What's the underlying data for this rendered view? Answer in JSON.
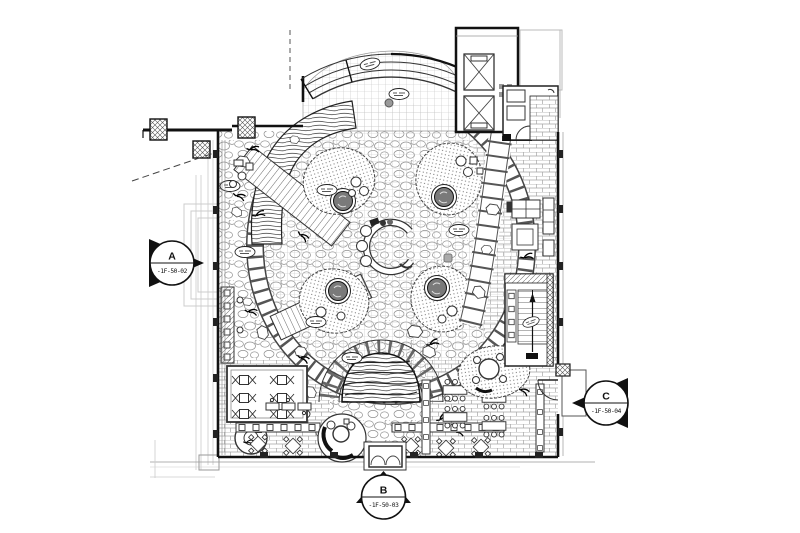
{
  "drawing": {
    "kind": "architectural-floor-plan",
    "description": "First floor restaurant / lounge plan with central C-shaped counter, oval planting islands, stone band, stair and elevator core"
  },
  "markers": {
    "a": {
      "letter": "A",
      "code": "-1F-50-02"
    },
    "b": {
      "letter": "B",
      "code": "-1F-50-03"
    },
    "c": {
      "letter": "C",
      "code": "-1F-50-04"
    }
  },
  "icons": {
    "tree-icon": "●",
    "elevator-x-icon": "✕",
    "stair-arrow-icon": "↑",
    "keynote-tag-icon": "▭",
    "section-arrow-icon": "▶"
  },
  "colors": {
    "ink": "#1a1a1a",
    "paper": "#ffffff",
    "faint_gray": "#c8c8c8",
    "mid_gray": "#777777",
    "tree_fill": "#7a7a7a"
  }
}
